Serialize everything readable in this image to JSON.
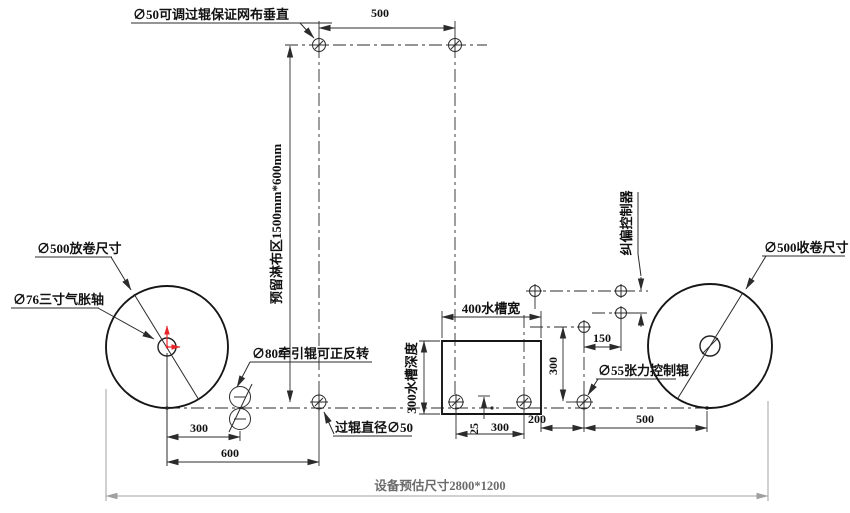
{
  "labels": {
    "adjustable_roller": "∅50可调过辊保证网布垂直",
    "reserved_zone": "预留淋布区1500mm*600mm",
    "unwind_size": "∅500放卷尺寸",
    "air_shaft": "∅76三寸气胀轴",
    "traction_roller": "∅80牵引辊可正反转",
    "pass_roller": "过辊直径∅50",
    "tank_width": "400水槽宽",
    "tank_depth": "300水槽深度",
    "deviation_controller": "纠偏控制器",
    "tension_roller": "∅55张力控制辊",
    "rewind_size": "∅500收卷尺寸",
    "overall_size": "设备预估尺寸2800*1200"
  },
  "dimensions": {
    "top_roller_span": "500",
    "unwind_to_traction": "300",
    "unwind_to_pass_roller": "600",
    "roller_offset": "25",
    "tank_roller_span": "300",
    "tank_to_tension": "200",
    "tension_to_rewind": "500",
    "tension_drop": "300",
    "controller_offset": "150"
  },
  "colors": {
    "line": "#2b2b2b",
    "overall_dim": "#a0a0a0",
    "accent_red": "#e8262a",
    "background": "#ffffff"
  }
}
